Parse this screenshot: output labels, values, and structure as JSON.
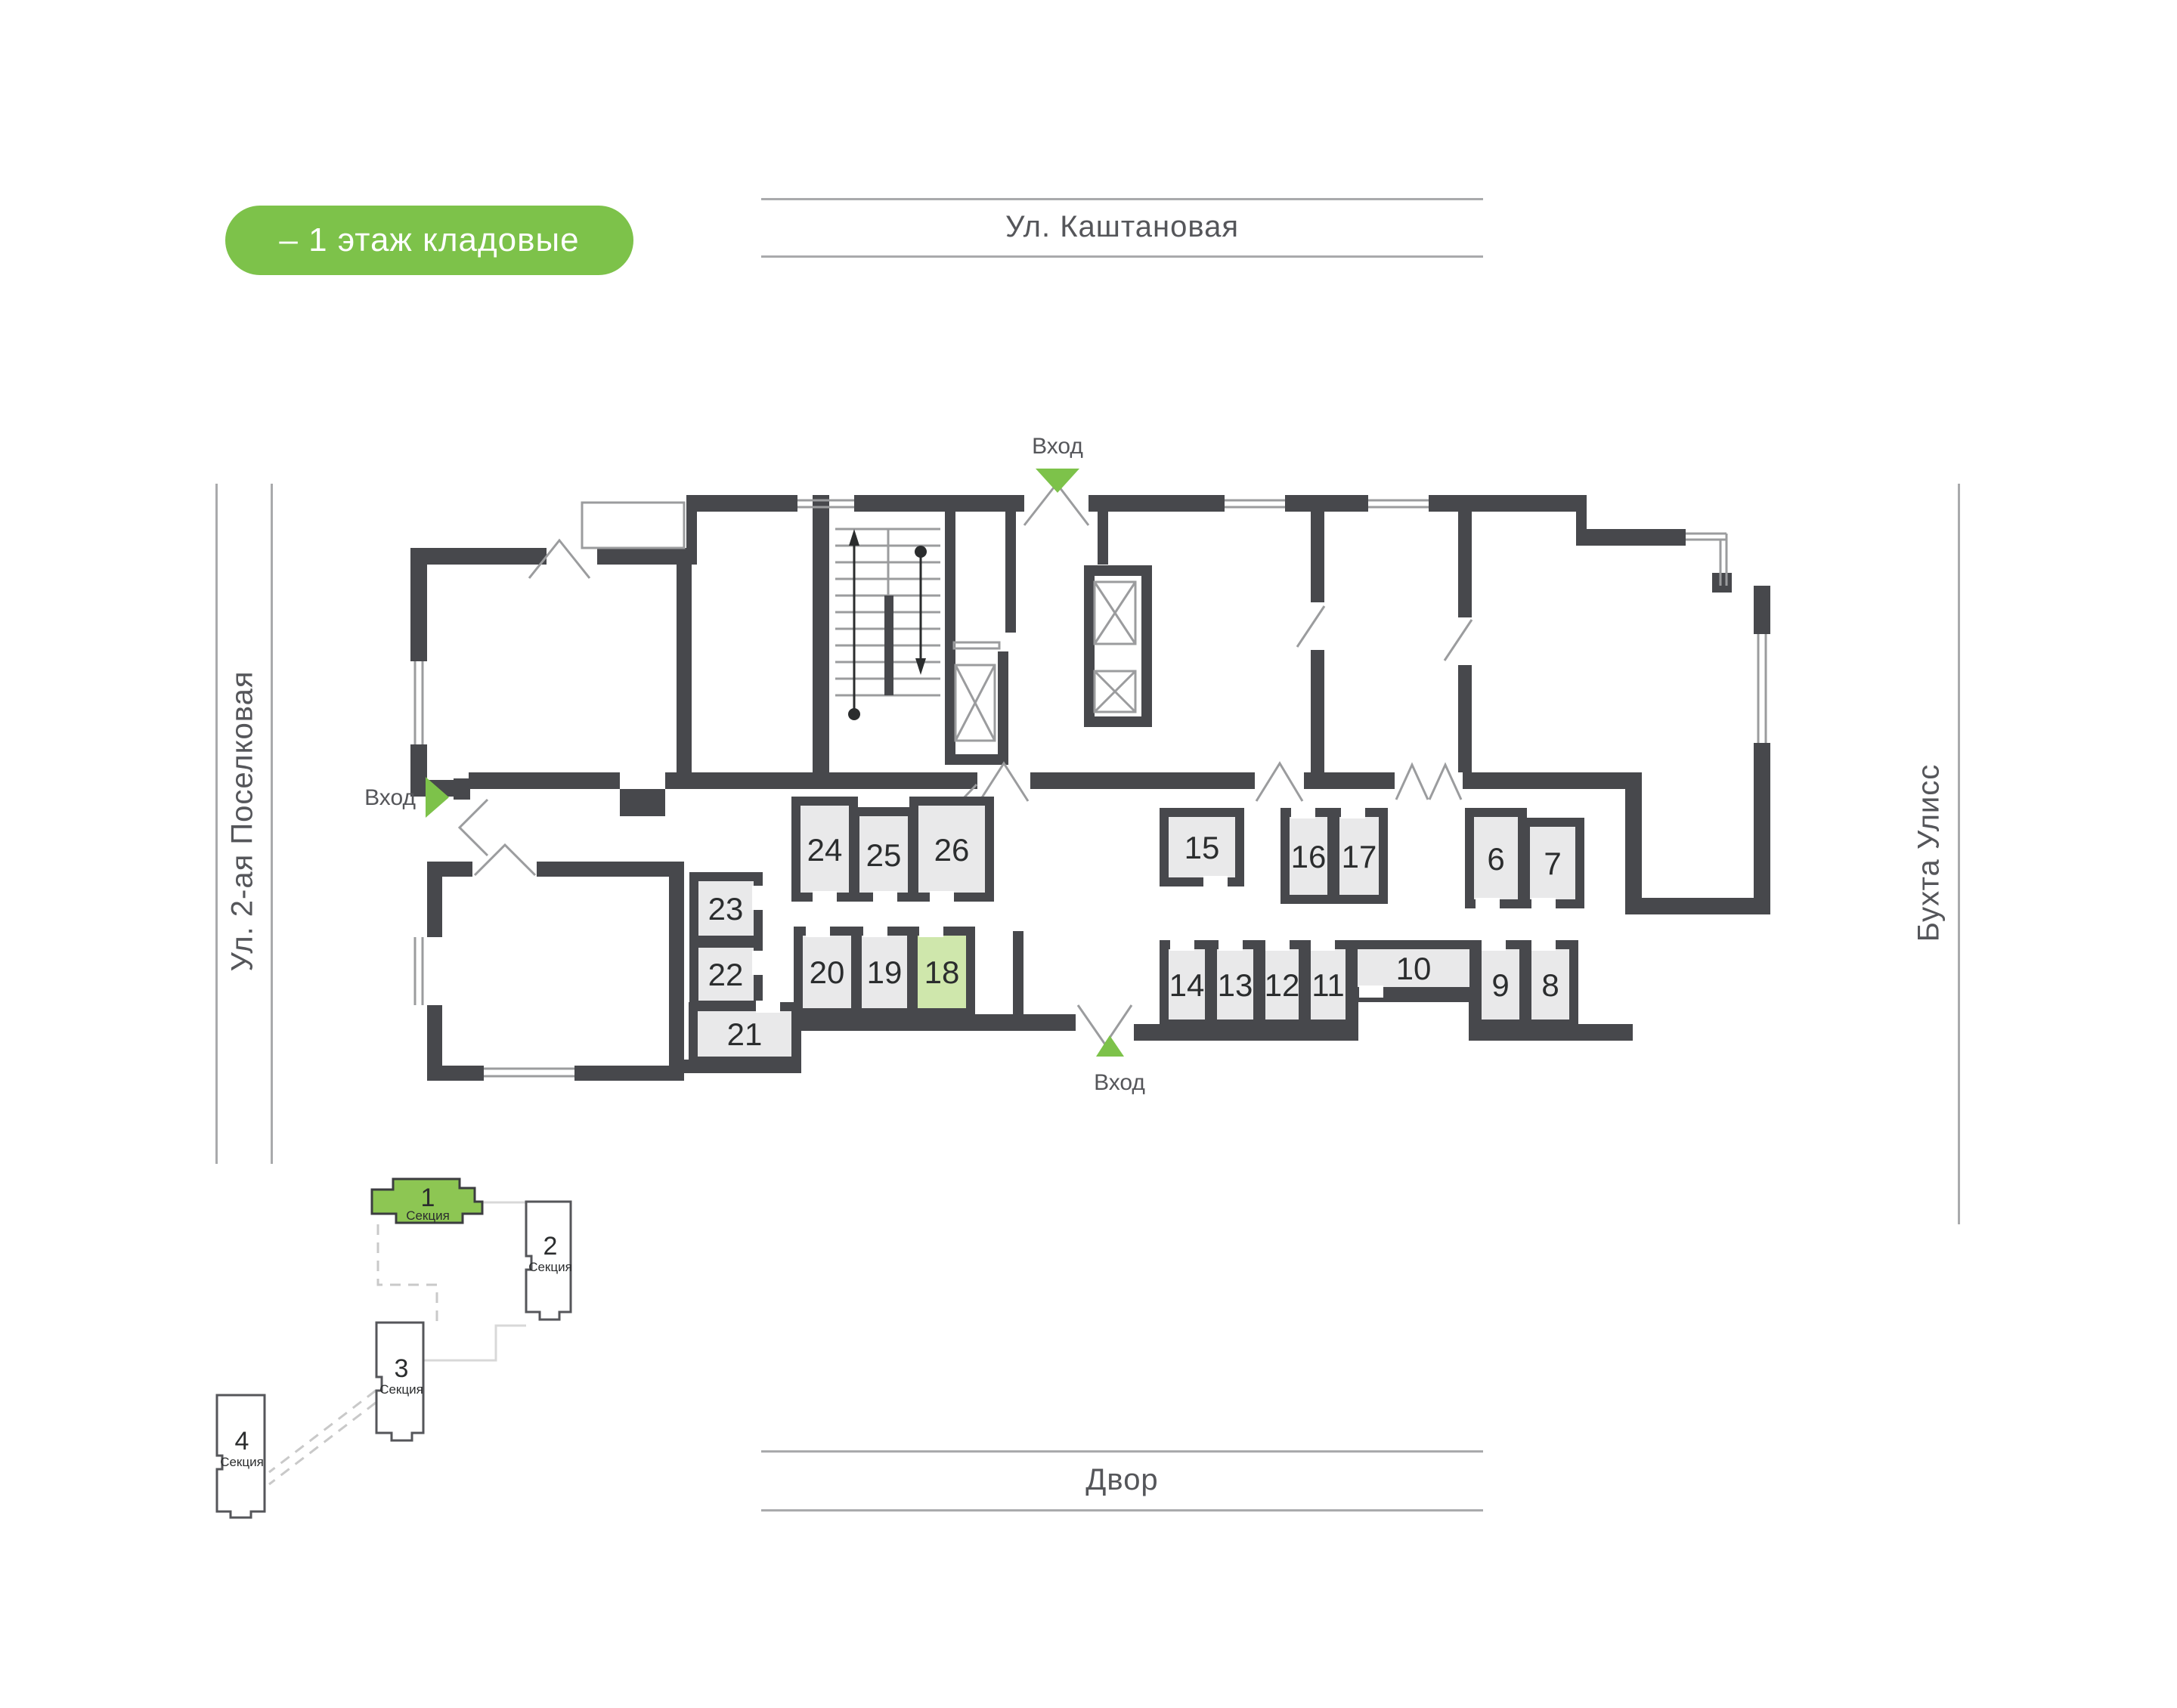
{
  "badge": {
    "label": "– 1 этаж кладовые"
  },
  "streets": {
    "top": "Ул. Каштановая",
    "left": "Ул. 2-ая Поселковая",
    "right": "Бухта Улисс",
    "bottom": "Двор"
  },
  "entrances": {
    "label": "Вход"
  },
  "plan": {
    "highlighted_room": "18",
    "rooms": {
      "r6": "6",
      "r7": "7",
      "r8": "8",
      "r9": "9",
      "r10": "10",
      "r11": "11",
      "r12": "12",
      "r13": "13",
      "r14": "14",
      "r15": "15",
      "r16": "16",
      "r17": "17",
      "r18": "18",
      "r19": "19",
      "r20": "20",
      "r21": "21",
      "r22": "22",
      "r23": "23",
      "r24": "24",
      "r25": "25",
      "r26": "26"
    }
  },
  "minimap": {
    "section_label": "Секция",
    "active_section": "1",
    "sections": [
      {
        "num": "1"
      },
      {
        "num": "2"
      },
      {
        "num": "3"
      },
      {
        "num": "4"
      }
    ]
  },
  "colors": {
    "accent_green": "#7dc24a",
    "section_active_green": "#8dc653",
    "room_fill": "#e9e9ea",
    "room_highlight": "#cfe7ac",
    "wall": "#47484c",
    "street_text": "#55565a",
    "thin_line": "#9b9c9e"
  }
}
